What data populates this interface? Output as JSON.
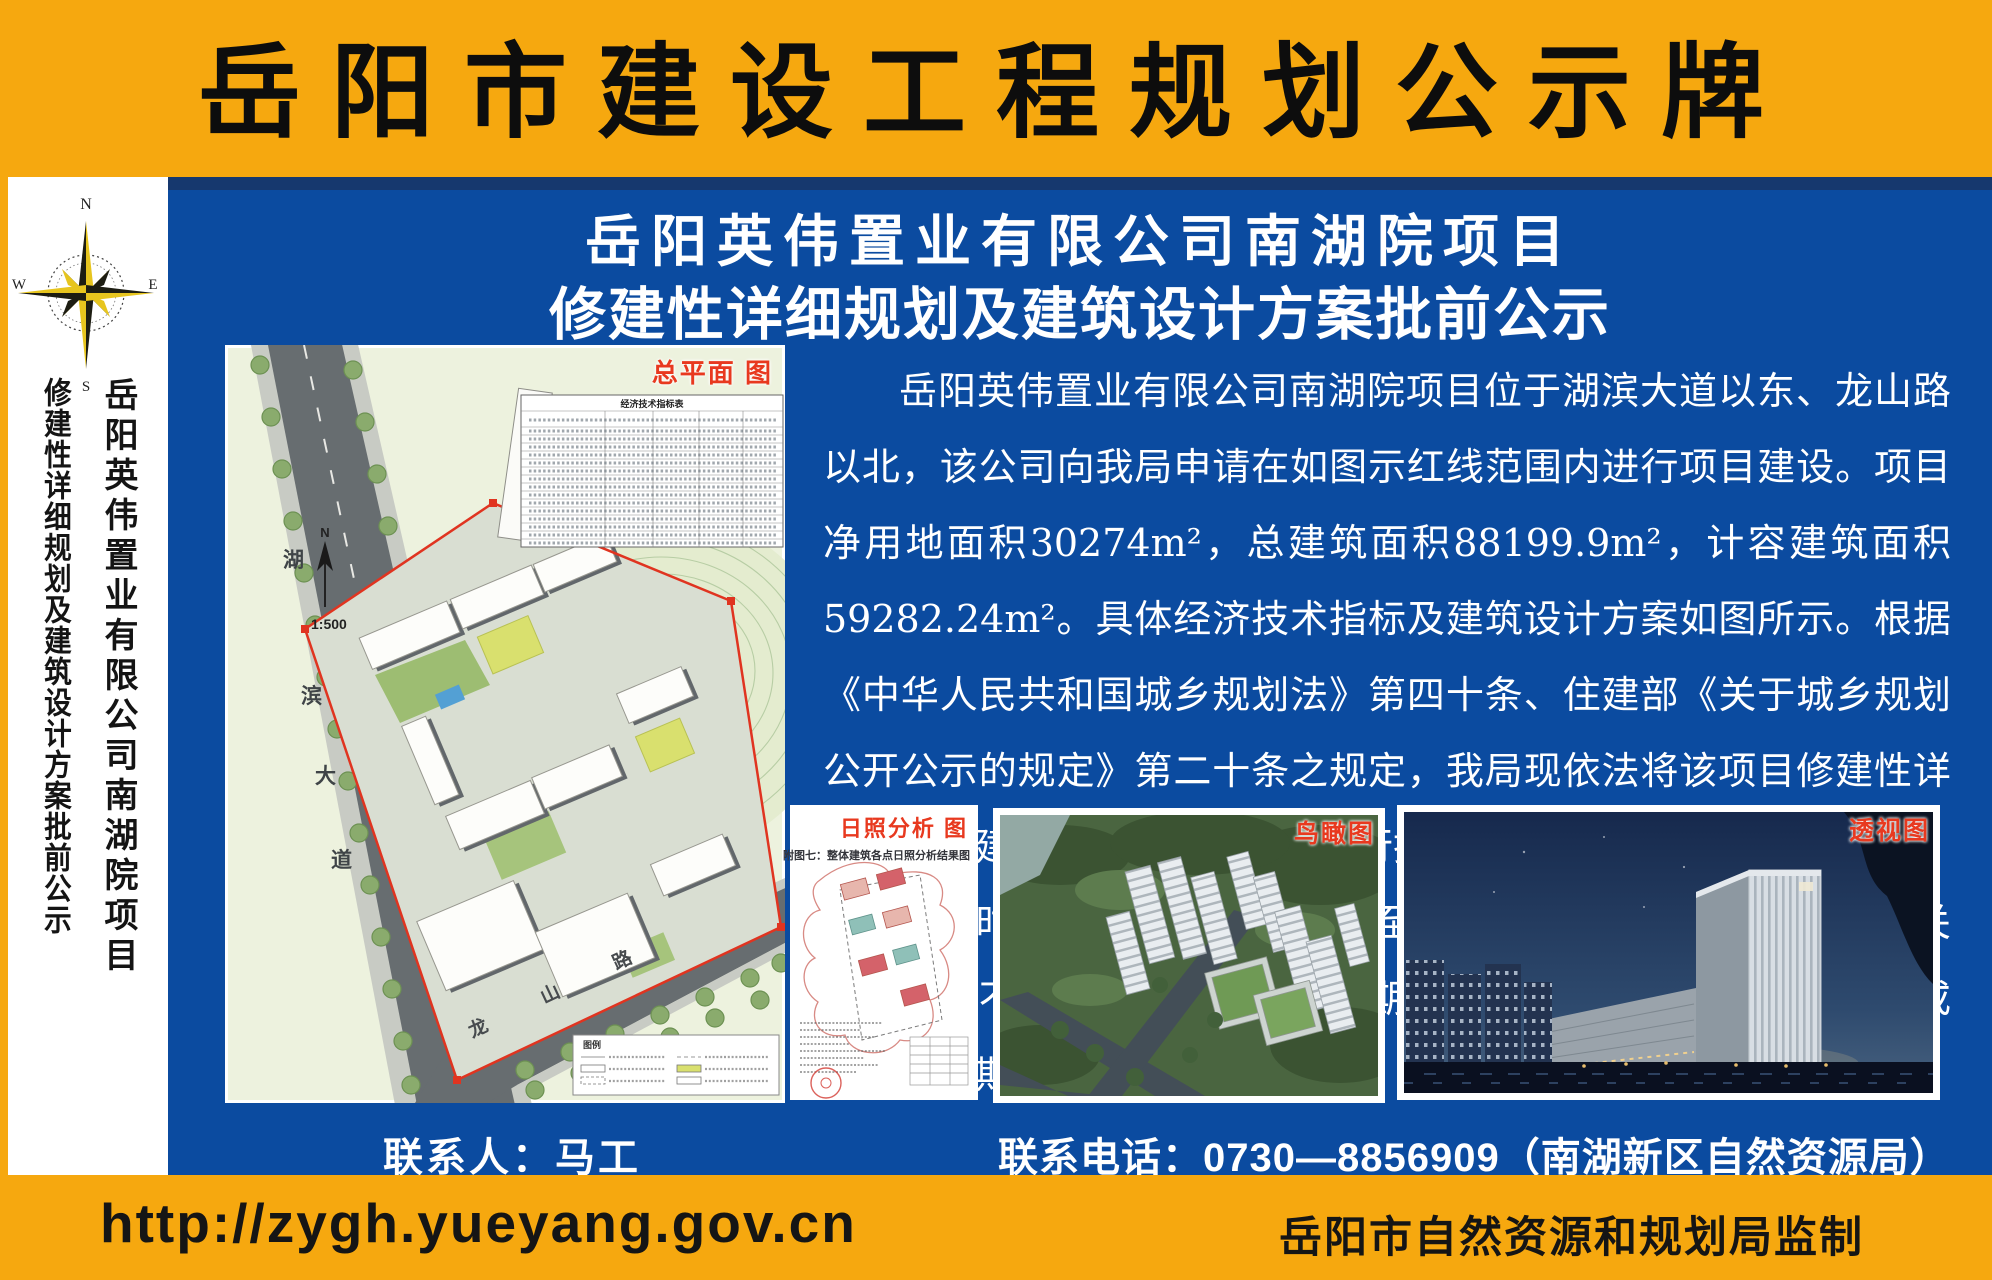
{
  "colors": {
    "frame_orange": "#f6a80f",
    "panel_blue": "#0b4ba0",
    "navy_strip": "#16386e",
    "label_red": "#e8391f",
    "text_black": "#0d0d0d",
    "text_white": "#ffffff"
  },
  "header": {
    "title": "岳阳市建设工程规划公示牌"
  },
  "sidebar": {
    "compass": {
      "n": "N",
      "e": "E",
      "s": "S",
      "w": "W"
    },
    "line1": "岳阳英伟置业有限公司南湖院项目",
    "line2": "修建性详细规划及建筑设计方案批前公示"
  },
  "main": {
    "title_line1": "岳阳英伟置业有限公司南湖院项目",
    "title_line2": "修建性详细规划及建筑设计方案批前公示",
    "paragraph1": "岳阳英伟置业有限公司南湖院项目位于湖滨大道以东、龙山路以北，该公司向我局申请在如图示红线范围内进行项目建设。项目净用地面积30274m²，总建筑面积88199.9m²，计容建筑面积59282.24m²。具体经济技术指标及建筑设计方案如图所示。根据《中华人民共和国城乡规划法》第四十条、住建部《关于城乡规划公开公示的规定》第二十条之规定，我局现依法将该项目修建性详细规划及建筑设计方案向社会进行批前公示。",
    "paragraph2": "公示时间为2025年11月6日至2025年11月14日。相关利害关系人若有不同意见，请在公示日期内以书面形式向我局提出意见或建议，逾期我局不再受理。",
    "contact_person": "联系人：马工",
    "contact_phone": "联系电话：0730—8856909（南湖新区自然资源局）"
  },
  "site_plan": {
    "label": "总平面 图",
    "table_title": "经济技术指标表",
    "legend_title": "图例",
    "scale": "1:500",
    "north": "N",
    "road_vertical": [
      "湖",
      "滨",
      "大",
      "道"
    ],
    "road_diagonal": [
      "龙",
      "山",
      "路"
    ]
  },
  "sunlight": {
    "label": "日照分析 图",
    "caption": "附图七：整体建筑各点日照分析结果图"
  },
  "birdseye": {
    "label": "鸟瞰图"
  },
  "perspective": {
    "label": "透视图"
  },
  "footer": {
    "url": "http://zygh.yueyang.gov.cn",
    "credit": "岳阳市自然资源和规划局监制"
  }
}
